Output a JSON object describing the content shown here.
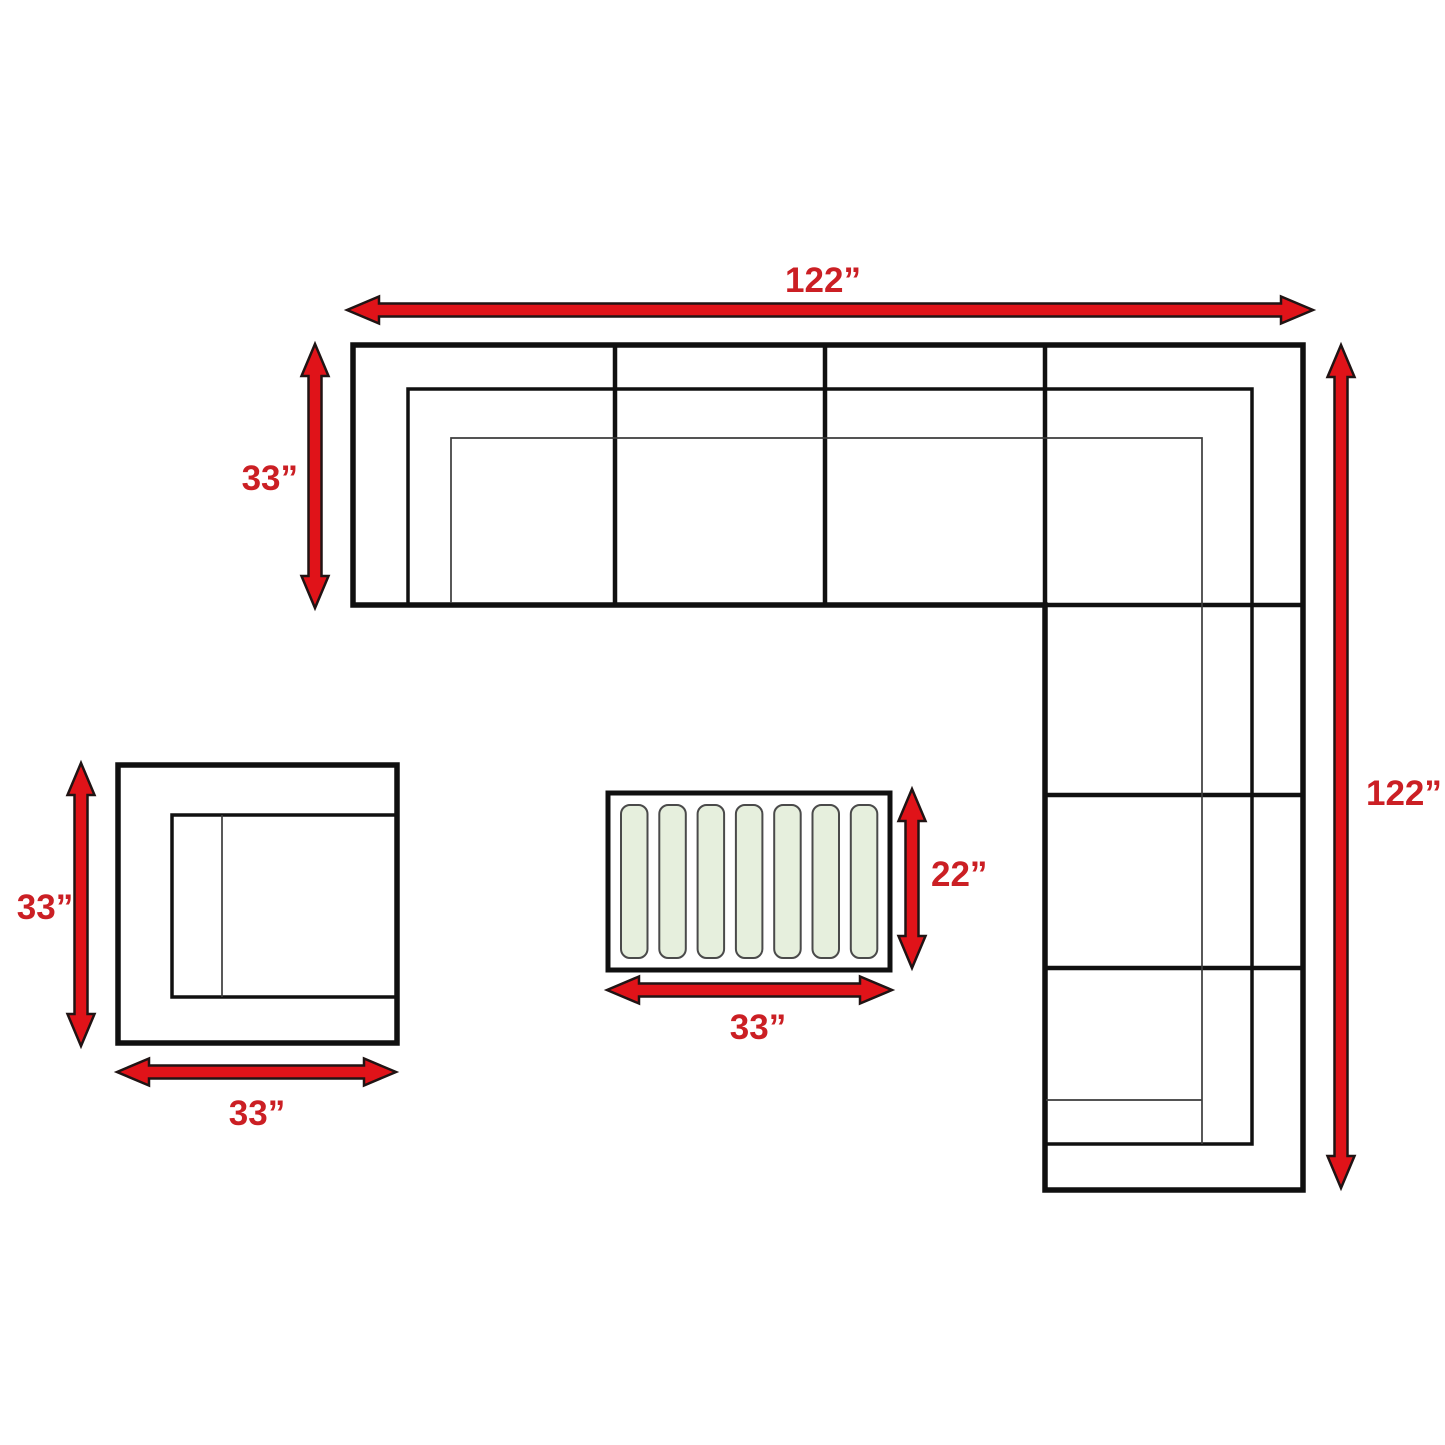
{
  "background": "#ffffff",
  "colors": {
    "outline": "#101010",
    "thin_line": "#3c3c3c",
    "arrow_fill": "#e01319",
    "arrow_stroke": "#201414",
    "label": "#cb1f24",
    "slat_fill": "#e6efdd",
    "slat_stroke": "#4a4a4a"
  },
  "dimensions": {
    "sofa_width": {
      "value": 122,
      "label": "122”"
    },
    "sofa_depth": {
      "value": 33,
      "label": "33”"
    },
    "sofa_length": {
      "value": 122,
      "label": "122”"
    },
    "chair_depth": {
      "value": 33,
      "label": "33”"
    },
    "chair_width": {
      "value": 33,
      "label": "33”"
    },
    "table_depth": {
      "value": 22,
      "label": "22”"
    },
    "table_width": {
      "value": 33,
      "label": "33”"
    }
  },
  "coffee_table": {
    "slat_count": 7
  }
}
